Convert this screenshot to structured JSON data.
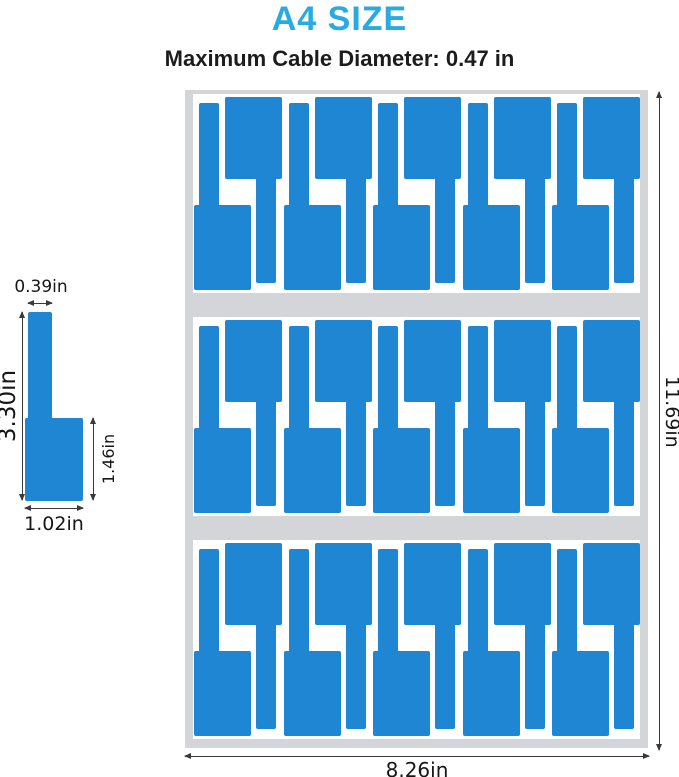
{
  "header": {
    "title": "A4 SIZE",
    "subtitle": "Maximum Cable Diameter: 0.47 in"
  },
  "colors": {
    "title_blue": "#29ABE2",
    "label_blue": "#1E86D2",
    "sheet_gray": "#D4D5D9",
    "dim_line": "#3A3A3A"
  },
  "single_label_diagram": {
    "stem_width_label": "0.39in",
    "total_height_label": "3.30in",
    "body_height_label": "1.46in",
    "body_width_label": "1.02in"
  },
  "sheet_diagram": {
    "width_label": "8.26in",
    "height_label": "11.69in",
    "rows": 3,
    "pairs_per_row": 5
  }
}
